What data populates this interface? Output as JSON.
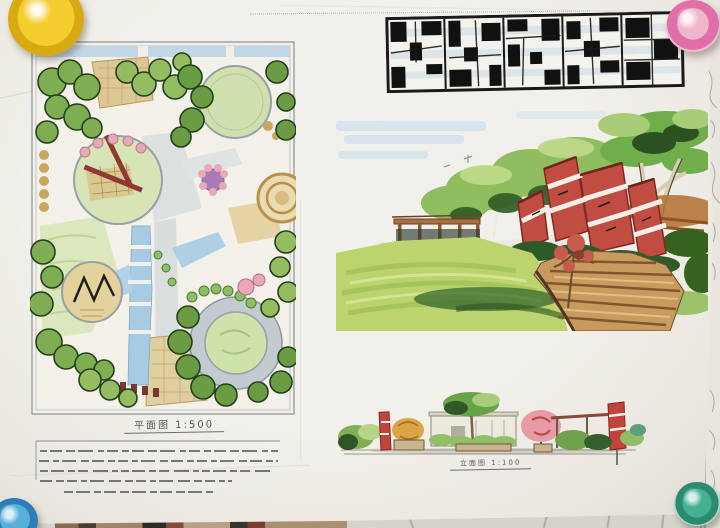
{
  "scene": {
    "description": "Photograph of a hand-drawn landscape design presentation board pinned to a tiled wall",
    "paper_color": "#f0eee8",
    "wall_color": "#d6d3cc"
  },
  "title_block": {
    "text": "染边设计",
    "style": "black-and-white mosaic calligraphy logotype with light-blue marker wash"
  },
  "plan_figure": {
    "label": "平面图",
    "scale": "1:500"
  },
  "elevation_figure": {
    "label": "立面图",
    "scale": "1:100"
  },
  "annotation": {
    "legible": false,
    "line_count": 5,
    "description": "small handwritten Chinese design notes under the plan"
  },
  "pins": [
    {
      "position": "top-left",
      "color": "#e9c224"
    },
    {
      "position": "top-right",
      "color": "#e06fa8"
    },
    {
      "position": "bottom-left",
      "color": "#2f7db8"
    },
    {
      "position": "bottom-right",
      "color": "#2b8a70"
    }
  ],
  "palette": {
    "tree_green": "#7fae52",
    "lawn_green": "#d6e4b6",
    "water_blue": "#a6cbe3",
    "accent_red": "#c14c42",
    "path_tan": "#c89a5e",
    "ink": "#1a1a1a"
  }
}
